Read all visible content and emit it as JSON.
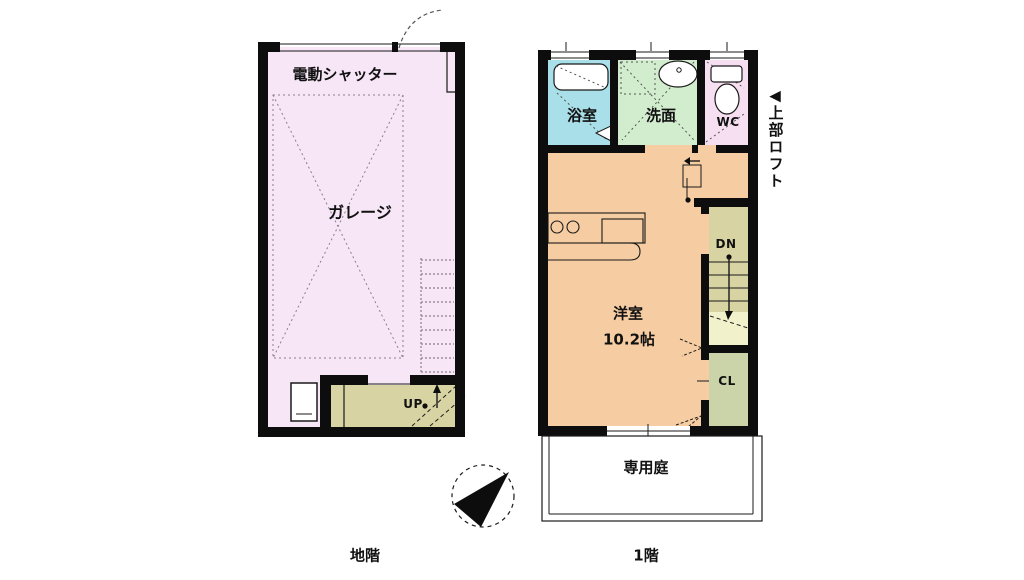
{
  "basement": {
    "floor_label": "地階",
    "shutter_label": "電動シャッター",
    "garage_label": "ガレージ",
    "up_label": "UP"
  },
  "first_floor": {
    "floor_label": "1階",
    "bath_label": "浴室",
    "wash_label": "洗面",
    "wc_label": "WC",
    "room_label": "洋室",
    "room_size": "10.2帖",
    "dn_label": "DN",
    "cl_label": "CL",
    "garden_label": "専用庭",
    "loft_arrow": "◀",
    "loft_label": "上部ロフト"
  },
  "colors": {
    "garage": "#f6e6f6",
    "bath": "#a8dfe8",
    "wash": "#d2ecce",
    "wc": "#f6dff0",
    "room": "#f6cda2",
    "stairs": "#d7d3a2",
    "stairs_light": "#f1f1cc",
    "closet": "#cbd4a8",
    "wall": "#0d0d0d"
  }
}
